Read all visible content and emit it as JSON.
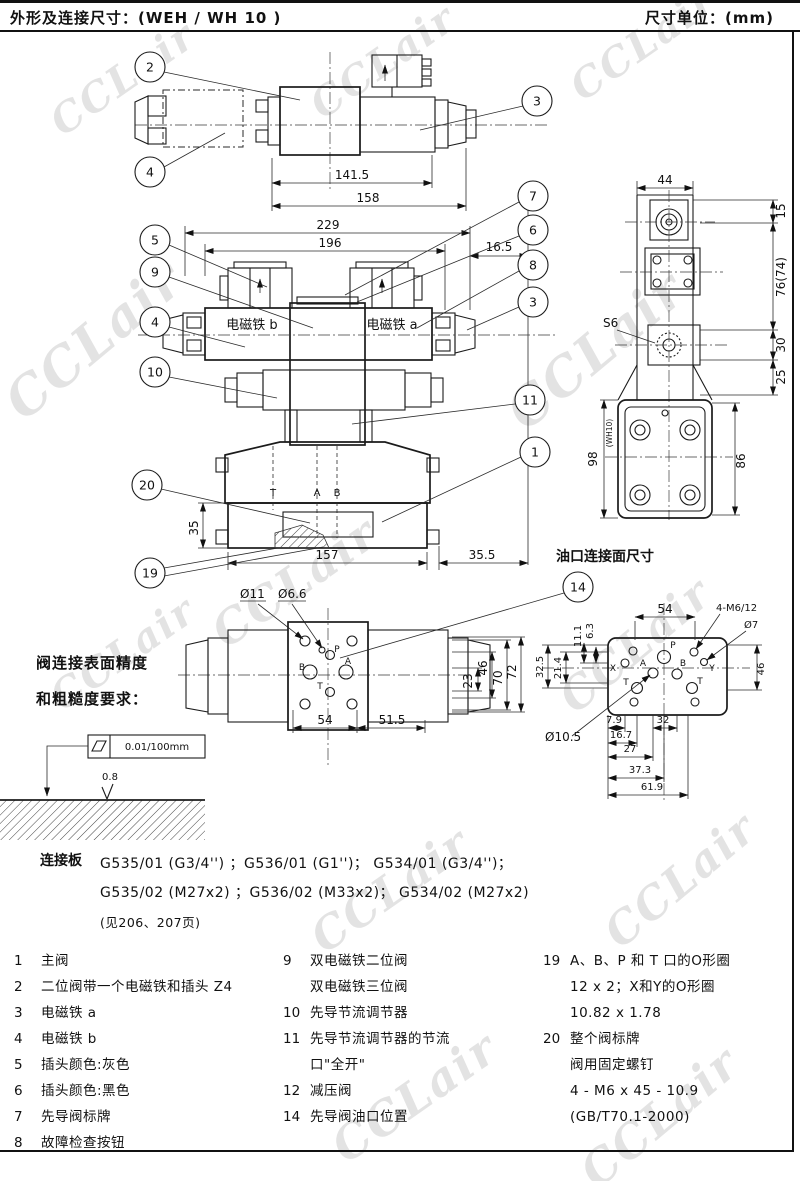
{
  "header": {
    "title": "外形及连接尺寸：(WEH / WH 10 )",
    "unit": "尺寸单位：(mm)"
  },
  "wm": {
    "text": "CCLair"
  },
  "tv": {
    "d141": "141.5",
    "d158": "158",
    "b2": "2",
    "b3": "3",
    "b4": "4"
  },
  "fv": {
    "d229": "229",
    "d196": "196",
    "d165": "16.5",
    "d35": "35",
    "d157": "157",
    "d355": "35.5",
    "sol_b": "电磁铁 b",
    "sol_a": "电磁铁 a",
    "pt": "T",
    "pa": "A",
    "pb": "B",
    "b1": "1",
    "b3": "3",
    "b4": "4",
    "b5": "5",
    "b6": "6",
    "b7": "7",
    "b8": "8",
    "b9": "9",
    "b10": "10",
    "b11": "11",
    "b19": "19",
    "b20": "20"
  },
  "sv": {
    "d44": "44",
    "d15": "15",
    "d76": "76(74)",
    "d30": "30",
    "d25": "25",
    "d98": "98",
    "wh10": "(WH10)",
    "d86": "86",
    "s6": "S6"
  },
  "bv": {
    "d11": "Ø11",
    "d66": "Ø6.6",
    "d54": "54",
    "d515": "51.5",
    "d23": "23",
    "d46": "46",
    "d70": "70",
    "d72": "72",
    "pp": "P",
    "pa": "A",
    "pb": "B",
    "pt": "T",
    "b14": "14"
  },
  "pf": {
    "title": "油口连接面尺寸",
    "d54": "54",
    "m6": "4-M6/12",
    "d7": "Ø7",
    "d63": "6.3",
    "d111": "11.1",
    "d214": "21.4",
    "d325": "32.5",
    "d46": "46",
    "d79": "7.9",
    "d32": "32",
    "d167": "16.7",
    "d27": "27",
    "d373": "37.3",
    "d619": "61.9",
    "d105": "Ø10.5",
    "px": "X",
    "pa": "A",
    "pp": "P",
    "pb": "B",
    "py": "Y",
    "pt1": "T",
    "pt2": "T"
  },
  "sn": {
    "line1": "阀连接表面精度",
    "line2": "和粗糙度要求：",
    "flatness": "0.01/100mm",
    "rough": "0.8"
  },
  "pn": {
    "label": "连接板",
    "line1": "G535/01 (G3/4'') ；G536/01 (G1'')； G534/01 (G3/4'')；",
    "line2": "G535/02 (M27x2) ；G536/02 (M33x2)； G534/02 (M27x2)",
    "line3": "(见206、207页)"
  },
  "parts": {
    "col1": [
      {
        "no": "1",
        "text": "主阀"
      },
      {
        "no": "2",
        "text": "二位阀带一个电磁铁和插头 Z4"
      },
      {
        "no": "3",
        "text": "电磁铁 a"
      },
      {
        "no": "4",
        "text": "电磁铁 b"
      },
      {
        "no": "5",
        "text": "插头颜色:灰色"
      },
      {
        "no": "6",
        "text": "插头颜色:黑色"
      },
      {
        "no": "7",
        "text": "先导阀标牌"
      },
      {
        "no": "8",
        "text": "故障检查按钮"
      }
    ],
    "col2": [
      {
        "no": "9",
        "text": "双电磁铁二位阀\n双电磁铁三位阀"
      },
      {
        "no": "10",
        "text": "先导节流调节器"
      },
      {
        "no": "11",
        "text": "先导节流调节器的节流\n口\"全开\""
      },
      {
        "no": "12",
        "text": "减压阀"
      },
      {
        "no": "14",
        "text": "先导阀油口位置"
      }
    ],
    "col3": [
      {
        "no": "19",
        "text": "A、B、P 和 T 口的O形圈\n12 x 2；X和Y的O形圈\n10.82 x 1.78"
      },
      {
        "no": "20",
        "text": "整个阀标牌\n阀用固定螺钉\n4 - M6 x 45 - 10.9\n(GB/T70.1-2000)"
      }
    ]
  }
}
